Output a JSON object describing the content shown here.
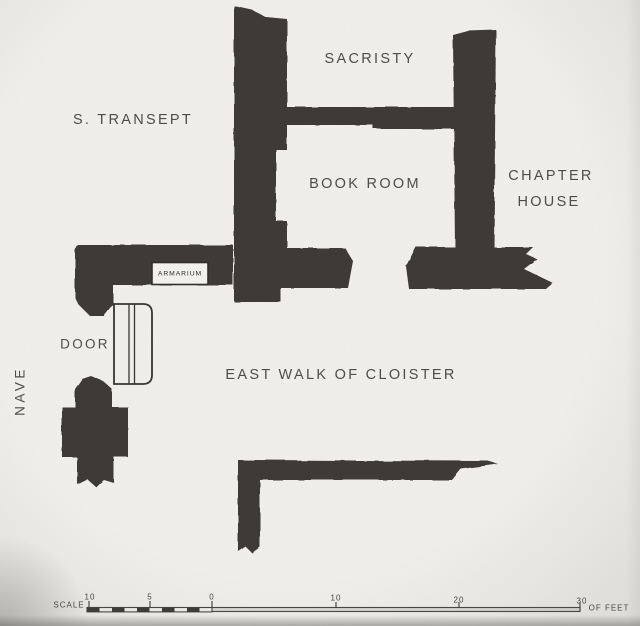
{
  "colors": {
    "paper": "#f2f0eb",
    "wall": "#3a3936",
    "text": "#4f4d49",
    "scale_fill": "#dbd9d3"
  },
  "rooms": {
    "sacristy": "SACRISTY",
    "s_transept": "S. TRANSEPT",
    "book_room": "BOOK ROOM",
    "chapter_house_line1": "CHAPTER",
    "chapter_house_line2": "HOUSE",
    "east_walk": "EAST WALK OF CLOISTER",
    "nave": "NAVE"
  },
  "features": {
    "armarium": "ARMARIUM",
    "door": "DOOR"
  },
  "scale_bar": {
    "label": "SCALE",
    "unit_label": "OF FEET",
    "left_ticks": [
      "10",
      "5",
      "0"
    ],
    "right_ticks": [
      "10",
      "20",
      "30"
    ]
  }
}
